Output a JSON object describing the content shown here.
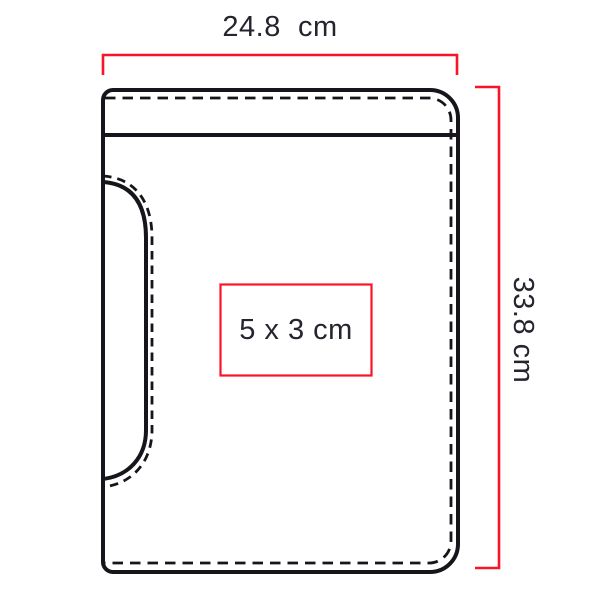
{
  "dimensions": {
    "width": {
      "label": "24.8  cm"
    },
    "height": {
      "label": "33.8 cm"
    }
  },
  "print_area": {
    "label": "5 x 3 cm"
  },
  "colors": {
    "dimension_red": "#f91528",
    "outline_black": "#17141b",
    "label_text": "#26242e",
    "background": "#ffffff"
  }
}
